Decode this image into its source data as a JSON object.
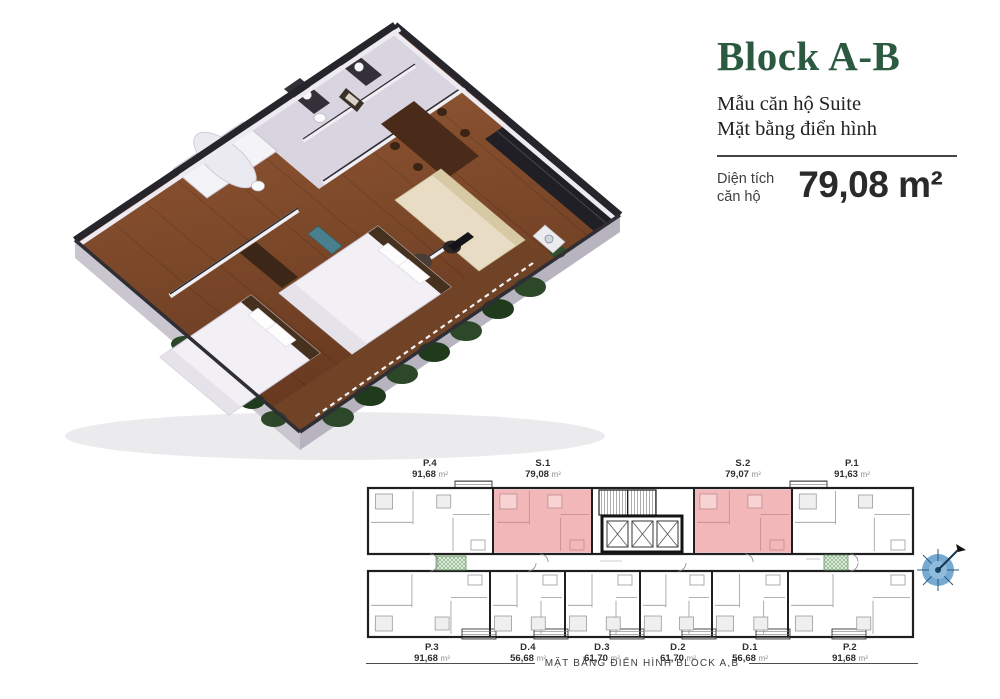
{
  "header": {
    "title": "Block A-B",
    "subtitle_lines": [
      "Mẫu căn hộ Suite",
      "Mặt bằng điển hình"
    ],
    "area_label_lines": [
      "Diện tích",
      "căn hộ"
    ],
    "area_value": "79,08 m²",
    "accent_color": "#2b5a40"
  },
  "floorplan": {
    "caption": "MẶT BẰNG ĐIỂN HÌNH BLOCK A,B",
    "highlight_color": "#f2b7b9",
    "compass_icon": "compass-rose-icon",
    "top_units": [
      {
        "id": "P.4",
        "area": "91,68",
        "unit": "m²",
        "highlighted": false
      },
      {
        "id": "S.1",
        "area": "79,08",
        "unit": "m²",
        "highlighted": true
      },
      {
        "id": "S.2",
        "area": "79,07",
        "unit": "m²",
        "highlighted": true
      },
      {
        "id": "P.1",
        "area": "91,63",
        "unit": "m²",
        "highlighted": false
      }
    ],
    "bottom_units": [
      {
        "id": "P.3",
        "area": "91,68",
        "unit": "m²",
        "highlighted": false
      },
      {
        "id": "D.4",
        "area": "56,68",
        "unit": "m²",
        "highlighted": false
      },
      {
        "id": "D.3",
        "area": "61,70",
        "unit": "m²",
        "highlighted": false
      },
      {
        "id": "D.2",
        "area": "61,70",
        "unit": "m²",
        "highlighted": false
      },
      {
        "id": "D.1",
        "area": "56,68",
        "unit": "m²",
        "highlighted": false
      },
      {
        "id": "P.2",
        "area": "91,68",
        "unit": "m²",
        "highlighted": false
      }
    ]
  }
}
